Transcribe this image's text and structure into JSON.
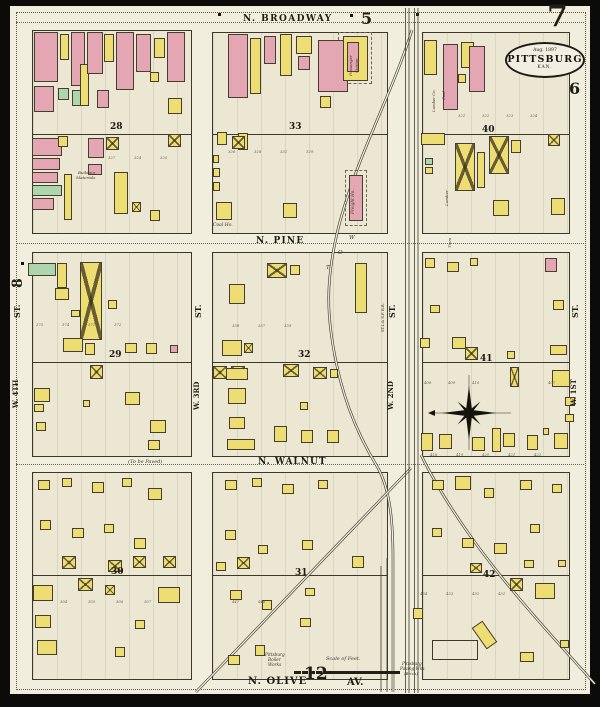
{
  "colors": {
    "paper": "#f1eedd",
    "block_fill": "#ece7d2",
    "frame_yellow": "#eedd72",
    "brick_pink": "#e4a6b2",
    "special_green": "#aed6ae",
    "ink": "#211e16",
    "rail": "#3f3b2e"
  },
  "seal": {
    "date": "Aug. 1897",
    "city": "PITTSBURG",
    "state": "KAN."
  },
  "sheet_numbers": {
    "top_right": "7",
    "top": "5",
    "right": "6",
    "left": "8",
    "bottom": "12"
  },
  "labels": [
    {
      "t": "N. BROADWAY",
      "x": 243,
      "y": 15,
      "s": 9,
      "b": 1,
      "ls": 1.4
    },
    {
      "t": "N. PINE",
      "x": 256,
      "y": 237,
      "s": 9,
      "b": 1,
      "ls": 1.2
    },
    {
      "t": "N. WALNUT",
      "x": 258,
      "y": 458,
      "s": 9,
      "b": 1,
      "ls": 1
    },
    {
      "t": "N. OLIVE",
      "x": 248,
      "y": 677,
      "s": 10,
      "b": 1,
      "ls": 1
    },
    {
      "t": "AV.",
      "x": 347,
      "y": 678,
      "s": 10,
      "b": 1
    },
    {
      "t": "5",
      "x": 361,
      "y": 11,
      "s": 16,
      "b": 1
    },
    {
      "t": "7",
      "x": 547,
      "y": 2,
      "s": 30,
      "b": 1
    },
    {
      "t": "6",
      "x": 569,
      "y": 81,
      "s": 16,
      "b": 1
    },
    {
      "t": "12",
      "x": 304,
      "y": 666,
      "s": 17,
      "b": 1
    },
    {
      "t": "8",
      "x": 11,
      "y": 288,
      "s": 14,
      "b": 1,
      "r": -90
    },
    {
      "t": "(To be Paved)",
      "x": 128,
      "y": 460,
      "s": 5,
      "i": 1
    },
    {
      "t": "Scale of Feet.",
      "x": 326,
      "y": 657,
      "s": 5,
      "i": 1
    },
    {
      "t": "Coal Ho.",
      "x": 213,
      "y": 224,
      "s": 4.5,
      "i": 1
    },
    {
      "t": "Building",
      "x": 78,
      "y": 171,
      "s": 4,
      "i": 1
    },
    {
      "t": "Materials",
      "x": 76,
      "y": 176,
      "s": 4,
      "i": 1
    },
    {
      "t": "Pittsburg",
      "x": 265,
      "y": 653,
      "s": 4.2,
      "i": 1
    },
    {
      "t": "Boiler",
      "x": 268,
      "y": 658,
      "s": 4.2,
      "i": 1
    },
    {
      "t": "Works",
      "x": 268,
      "y": 663,
      "s": 4.2,
      "i": 1
    },
    {
      "t": "Pittsburg",
      "x": 402,
      "y": 662,
      "s": 4.2,
      "i": 1
    },
    {
      "t": "Paving Wks",
      "x": 400,
      "y": 667,
      "s": 4.2,
      "i": 1
    },
    {
      "t": "(Brick)",
      "x": 404,
      "y": 672,
      "s": 4,
      "i": 1
    },
    {
      "t": "W",
      "x": 349,
      "y": 236,
      "s": 5.5,
      "i": 1
    },
    {
      "t": "O",
      "x": 338,
      "y": 251,
      "s": 5.5,
      "i": 1
    },
    {
      "t": "T",
      "x": 326,
      "y": 266,
      "s": 5.5,
      "i": 1
    },
    {
      "t": "ST.",
      "x": 13,
      "y": 318,
      "s": 8,
      "b": 1,
      "r": -90
    },
    {
      "t": "W. 4TH",
      "x": 12,
      "y": 408,
      "s": 7,
      "b": 1,
      "r": -90
    },
    {
      "t": "ST.",
      "x": 194,
      "y": 318,
      "s": 8,
      "b": 1,
      "r": -90
    },
    {
      "t": "W. 3RD",
      "x": 193,
      "y": 410,
      "s": 7,
      "b": 1,
      "r": -90
    },
    {
      "t": "ST.",
      "x": 388,
      "y": 318,
      "s": 8,
      "b": 1,
      "r": -90
    },
    {
      "t": "W. 2ND",
      "x": 387,
      "y": 410,
      "s": 7,
      "b": 1,
      "r": -90
    },
    {
      "t": "ST.",
      "x": 571,
      "y": 318,
      "s": 8,
      "b": 1,
      "r": -90
    },
    {
      "t": "W. 1ST",
      "x": 570,
      "y": 406,
      "s": 7,
      "b": 1,
      "r": -90
    },
    {
      "t": "Freight Ho.",
      "x": 351,
      "y": 214,
      "s": 4.2,
      "i": 1,
      "r": -90
    },
    {
      "t": "Passenger",
      "x": 349,
      "y": 76,
      "s": 4,
      "i": 1,
      "r": -90
    },
    {
      "t": "Station",
      "x": 355,
      "y": 73,
      "s": 4,
      "i": 1,
      "r": -90
    },
    {
      "t": "Lumber Co.",
      "x": 432,
      "y": 112,
      "s": 3.8,
      "i": 1,
      "r": -90
    },
    {
      "t": "Coal",
      "x": 442,
      "y": 100,
      "s": 3.8,
      "i": 1,
      "r": -90
    },
    {
      "t": "Lumber",
      "x": 445,
      "y": 206,
      "s": 4,
      "i": 1,
      "r": -90
    },
    {
      "t": "Tiers",
      "x": 448,
      "y": 248,
      "s": 4,
      "i": 1,
      "r": -90
    },
    {
      "t": "ST.L.& S.F. R.R.",
      "x": 382,
      "y": 332,
      "s": 3.6,
      "r": -90
    }
  ],
  "block_numbers": [
    [
      "28",
      110,
      123
    ],
    [
      "33",
      289,
      123
    ],
    [
      "40",
      482,
      126
    ],
    [
      "29",
      109,
      351
    ],
    [
      "32",
      298,
      351
    ],
    [
      "41",
      480,
      355
    ],
    [
      "30",
      111,
      568
    ],
    [
      "31",
      295,
      569
    ],
    [
      "42",
      483,
      571
    ]
  ],
  "lot_numbers": [
    [
      "327",
      108,
      156
    ],
    [
      "324",
      134,
      156
    ],
    [
      "325",
      160,
      156
    ],
    [
      "326",
      228,
      150
    ],
    [
      "328",
      254,
      150
    ],
    [
      "331",
      280,
      150
    ],
    [
      "329",
      306,
      150
    ],
    [
      "321",
      458,
      114
    ],
    [
      "322",
      482,
      114
    ],
    [
      "323",
      506,
      114
    ],
    [
      "324",
      530,
      114
    ],
    [
      "375",
      36,
      323
    ],
    [
      "374",
      62,
      323
    ],
    [
      "371",
      88,
      323
    ],
    [
      "372",
      114,
      323
    ],
    [
      "358",
      232,
      324
    ],
    [
      "357",
      258,
      324
    ],
    [
      "359",
      284,
      324
    ],
    [
      "408",
      424,
      381
    ],
    [
      "409",
      448,
      381
    ],
    [
      "410",
      472,
      381
    ],
    [
      "407",
      548,
      381
    ],
    [
      "418",
      430,
      453
    ],
    [
      "419",
      456,
      453
    ],
    [
      "420",
      482,
      453
    ],
    [
      "421",
      508,
      453
    ],
    [
      "422",
      534,
      453
    ],
    [
      "304",
      60,
      600
    ],
    [
      "305",
      88,
      600
    ],
    [
      "306",
      116,
      600
    ],
    [
      "307",
      144,
      600
    ],
    [
      "447",
      232,
      600
    ],
    [
      "448",
      258,
      600
    ],
    [
      "434",
      420,
      592
    ],
    [
      "433",
      446,
      592
    ],
    [
      "432",
      472,
      592
    ],
    [
      "431",
      498,
      592
    ]
  ],
  "blocks": [
    [
      32,
      30,
      158,
      202,
      133
    ],
    [
      212,
      32,
      174,
      200,
      133
    ],
    [
      422,
      32,
      146,
      200,
      133
    ],
    [
      32,
      252,
      158,
      203,
      361
    ],
    [
      212,
      252,
      174,
      203,
      361
    ],
    [
      422,
      252,
      146,
      203,
      361
    ],
    [
      32,
      472,
      158,
      206,
      574
    ],
    [
      212,
      472,
      174,
      206,
      574
    ],
    [
      422,
      472,
      146,
      206,
      574
    ]
  ],
  "buildings": [
    [
      34,
      32,
      24,
      50,
      "P"
    ],
    [
      34,
      86,
      20,
      26,
      "P"
    ],
    [
      60,
      34,
      9,
      26,
      "Y"
    ],
    [
      58,
      88,
      11,
      12,
      "G"
    ],
    [
      71,
      32,
      14,
      54,
      "P"
    ],
    [
      72,
      90,
      11,
      16,
      "G"
    ],
    [
      80,
      64,
      9,
      42,
      "Y"
    ],
    [
      87,
      32,
      16,
      42,
      "P"
    ],
    [
      104,
      34,
      10,
      28,
      "Y"
    ],
    [
      116,
      32,
      18,
      58,
      "P"
    ],
    [
      136,
      34,
      15,
      38,
      "P"
    ],
    [
      154,
      38,
      11,
      20,
      "Y"
    ],
    [
      150,
      72,
      9,
      10,
      "Y"
    ],
    [
      167,
      32,
      18,
      50,
      "P"
    ],
    [
      168,
      98,
      14,
      16,
      "Y"
    ],
    [
      97,
      90,
      12,
      18,
      "P"
    ],
    [
      32,
      138,
      30,
      18,
      "P"
    ],
    [
      32,
      158,
      28,
      12,
      "P"
    ],
    [
      32,
      172,
      26,
      11,
      "P"
    ],
    [
      32,
      185,
      30,
      11,
      "G"
    ],
    [
      32,
      198,
      22,
      12,
      "P"
    ],
    [
      58,
      136,
      10,
      11,
      "Y"
    ],
    [
      64,
      174,
      8,
      46,
      "Y"
    ],
    [
      88,
      138,
      16,
      20,
      "P"
    ],
    [
      106,
      137,
      13,
      13,
      "Yx"
    ],
    [
      88,
      164,
      14,
      11,
      "P"
    ],
    [
      114,
      172,
      14,
      42,
      "Y"
    ],
    [
      132,
      202,
      9,
      10,
      "Yx"
    ],
    [
      168,
      134,
      13,
      13,
      "Yx"
    ],
    [
      150,
      210,
      10,
      11,
      "Y"
    ],
    [
      338,
      32,
      34,
      52,
      "D"
    ],
    [
      228,
      34,
      20,
      64,
      "P"
    ],
    [
      250,
      38,
      11,
      56,
      "Y"
    ],
    [
      264,
      36,
      12,
      28,
      "P"
    ],
    [
      280,
      34,
      12,
      42,
      "Y"
    ],
    [
      296,
      36,
      16,
      18,
      "Y"
    ],
    [
      298,
      56,
      12,
      14,
      "P"
    ],
    [
      318,
      40,
      30,
      52,
      "P"
    ],
    [
      320,
      96,
      11,
      12,
      "Y"
    ],
    [
      343,
      36,
      25,
      45,
      "Y"
    ],
    [
      347,
      42,
      12,
      30,
      "P"
    ],
    [
      217,
      132,
      10,
      13,
      "Y"
    ],
    [
      238,
      133,
      10,
      17,
      "Y"
    ],
    [
      232,
      136,
      13,
      13,
      "Yx"
    ],
    [
      213,
      155,
      6,
      8,
      "Y"
    ],
    [
      213,
      168,
      7,
      9,
      "Y"
    ],
    [
      213,
      182,
      7,
      9,
      "Y"
    ],
    [
      216,
      202,
      16,
      18,
      "Y"
    ],
    [
      283,
      203,
      14,
      15,
      "Y"
    ],
    [
      345,
      170,
      22,
      56,
      "D"
    ],
    [
      349,
      175,
      14,
      46,
      "P"
    ],
    [
      424,
      40,
      13,
      35,
      "Y"
    ],
    [
      443,
      44,
      15,
      66,
      "P"
    ],
    [
      461,
      42,
      13,
      26,
      "Y"
    ],
    [
      469,
      46,
      16,
      46,
      "P"
    ],
    [
      458,
      74,
      8,
      9,
      "Y"
    ],
    [
      421,
      133,
      24,
      12,
      "Y"
    ],
    [
      425,
      158,
      8,
      7,
      "G"
    ],
    [
      425,
      167,
      8,
      7,
      "Y"
    ],
    [
      455,
      143,
      20,
      48,
      "Yx"
    ],
    [
      477,
      152,
      8,
      36,
      "Y"
    ],
    [
      489,
      136,
      20,
      38,
      "Yx"
    ],
    [
      511,
      140,
      10,
      13,
      "Y"
    ],
    [
      548,
      134,
      12,
      12,
      "Yx"
    ],
    [
      493,
      200,
      16,
      16,
      "Y"
    ],
    [
      551,
      198,
      14,
      17,
      "Y"
    ],
    [
      28,
      263,
      28,
      13,
      "G"
    ],
    [
      57,
      263,
      10,
      25,
      "Y"
    ],
    [
      55,
      288,
      14,
      12,
      "Y"
    ],
    [
      80,
      262,
      22,
      78,
      "Yx"
    ],
    [
      71,
      310,
      9,
      7,
      "Y"
    ],
    [
      108,
      300,
      9,
      9,
      "Y"
    ],
    [
      63,
      338,
      20,
      14,
      "Y"
    ],
    [
      85,
      343,
      10,
      12,
      "Y"
    ],
    [
      125,
      343,
      12,
      10,
      "Y"
    ],
    [
      146,
      343,
      11,
      11,
      "Y"
    ],
    [
      170,
      345,
      8,
      8,
      "P"
    ],
    [
      90,
      365,
      13,
      14,
      "Yx"
    ],
    [
      34,
      388,
      16,
      14,
      "Y"
    ],
    [
      34,
      404,
      10,
      8,
      "Y"
    ],
    [
      36,
      422,
      10,
      9,
      "Y"
    ],
    [
      125,
      392,
      15,
      13,
      "Y"
    ],
    [
      83,
      400,
      7,
      7,
      "Y"
    ],
    [
      150,
      420,
      16,
      13,
      "Y"
    ],
    [
      148,
      440,
      12,
      10,
      "Y"
    ],
    [
      267,
      263,
      20,
      15,
      "Yx"
    ],
    [
      290,
      265,
      10,
      10,
      "Y"
    ],
    [
      355,
      263,
      12,
      50,
      "Y"
    ],
    [
      229,
      284,
      16,
      20,
      "Y"
    ],
    [
      222,
      340,
      20,
      16,
      "Y"
    ],
    [
      244,
      343,
      9,
      10,
      "Yx"
    ],
    [
      213,
      366,
      14,
      13,
      "Yx"
    ],
    [
      231,
      366,
      14,
      13,
      "Yx"
    ],
    [
      283,
      364,
      16,
      13,
      "Yx"
    ],
    [
      313,
      367,
      14,
      12,
      "Yx"
    ],
    [
      330,
      369,
      8,
      9,
      "Y"
    ],
    [
      226,
      368,
      22,
      12,
      "Y"
    ],
    [
      228,
      388,
      18,
      16,
      "Y"
    ],
    [
      229,
      417,
      16,
      12,
      "Y"
    ],
    [
      227,
      439,
      28,
      11,
      "Y"
    ],
    [
      274,
      426,
      13,
      16,
      "Y"
    ],
    [
      301,
      430,
      12,
      13,
      "Y"
    ],
    [
      327,
      430,
      12,
      13,
      "Y"
    ],
    [
      300,
      402,
      8,
      8,
      "Y"
    ],
    [
      425,
      258,
      10,
      10,
      "Y"
    ],
    [
      447,
      262,
      12,
      10,
      "Y"
    ],
    [
      470,
      258,
      8,
      8,
      "Y"
    ],
    [
      545,
      258,
      12,
      14,
      "P"
    ],
    [
      430,
      305,
      10,
      8,
      "Y"
    ],
    [
      553,
      300,
      11,
      10,
      "Y"
    ],
    [
      420,
      338,
      10,
      10,
      "Y"
    ],
    [
      452,
      337,
      14,
      12,
      "Y"
    ],
    [
      465,
      347,
      13,
      13,
      "Yx"
    ],
    [
      507,
      351,
      8,
      8,
      "Y"
    ],
    [
      550,
      345,
      17,
      10,
      "Y"
    ],
    [
      510,
      367,
      9,
      20,
      "Yx"
    ],
    [
      552,
      370,
      18,
      17,
      "Y"
    ],
    [
      421,
      433,
      12,
      18,
      "Y"
    ],
    [
      439,
      434,
      13,
      15,
      "Y"
    ],
    [
      472,
      437,
      13,
      14,
      "Y"
    ],
    [
      492,
      428,
      9,
      24,
      "Y"
    ],
    [
      503,
      433,
      12,
      14,
      "Y"
    ],
    [
      527,
      435,
      11,
      15,
      "Y"
    ],
    [
      554,
      433,
      14,
      16,
      "Y"
    ],
    [
      565,
      397,
      10,
      9,
      "Y"
    ],
    [
      565,
      414,
      9,
      8,
      "Y"
    ],
    [
      543,
      428,
      6,
      7,
      "Y"
    ],
    [
      38,
      480,
      12,
      10,
      "Y"
    ],
    [
      62,
      478,
      10,
      9,
      "Y"
    ],
    [
      92,
      482,
      12,
      11,
      "Y"
    ],
    [
      122,
      478,
      10,
      9,
      "Y"
    ],
    [
      148,
      488,
      14,
      12,
      "Y"
    ],
    [
      40,
      520,
      11,
      10,
      "Y"
    ],
    [
      72,
      528,
      12,
      10,
      "Y"
    ],
    [
      104,
      524,
      10,
      9,
      "Y"
    ],
    [
      134,
      538,
      12,
      11,
      "Y"
    ],
    [
      62,
      556,
      14,
      13,
      "Yx"
    ],
    [
      108,
      560,
      14,
      12,
      "Yx"
    ],
    [
      133,
      556,
      13,
      12,
      "Yx"
    ],
    [
      163,
      556,
      13,
      12,
      "Yx"
    ],
    [
      78,
      578,
      15,
      13,
      "Yx"
    ],
    [
      105,
      585,
      10,
      10,
      "Yx"
    ],
    [
      33,
      585,
      20,
      16,
      "Y"
    ],
    [
      35,
      615,
      16,
      13,
      "Y"
    ],
    [
      37,
      640,
      20,
      15,
      "Y"
    ],
    [
      115,
      647,
      10,
      10,
      "Y"
    ],
    [
      158,
      587,
      22,
      16,
      "Y"
    ],
    [
      135,
      620,
      10,
      9,
      "Y"
    ],
    [
      225,
      480,
      12,
      10,
      "Y"
    ],
    [
      252,
      478,
      10,
      9,
      "Y"
    ],
    [
      282,
      484,
      12,
      10,
      "Y"
    ],
    [
      318,
      480,
      10,
      9,
      "Y"
    ],
    [
      225,
      530,
      11,
      10,
      "Y"
    ],
    [
      258,
      545,
      10,
      9,
      "Y"
    ],
    [
      302,
      540,
      11,
      10,
      "Y"
    ],
    [
      237,
      557,
      13,
      12,
      "Yx"
    ],
    [
      216,
      562,
      10,
      9,
      "Y"
    ],
    [
      352,
      556,
      12,
      12,
      "Y"
    ],
    [
      230,
      590,
      12,
      10,
      "Y"
    ],
    [
      262,
      600,
      10,
      10,
      "Y"
    ],
    [
      300,
      618,
      11,
      9,
      "Y"
    ],
    [
      255,
      645,
      10,
      11,
      "Y"
    ],
    [
      228,
      655,
      12,
      10,
      "Y"
    ],
    [
      305,
      588,
      10,
      8,
      "Y"
    ],
    [
      432,
      480,
      12,
      10,
      "Y"
    ],
    [
      455,
      476,
      16,
      14,
      "Y"
    ],
    [
      484,
      488,
      10,
      10,
      "Y"
    ],
    [
      520,
      480,
      12,
      10,
      "Y"
    ],
    [
      552,
      484,
      10,
      9,
      "Y"
    ],
    [
      432,
      528,
      10,
      9,
      "Y"
    ],
    [
      462,
      538,
      12,
      10,
      "Y"
    ],
    [
      494,
      543,
      13,
      11,
      "Y"
    ],
    [
      530,
      524,
      10,
      9,
      "Y"
    ],
    [
      524,
      560,
      10,
      8,
      "Y"
    ],
    [
      470,
      563,
      12,
      10,
      "Yx"
    ],
    [
      558,
      560,
      8,
      7,
      "Y"
    ],
    [
      510,
      578,
      13,
      13,
      "Yx"
    ],
    [
      535,
      583,
      20,
      16,
      "Y"
    ],
    [
      413,
      608,
      10,
      11,
      "Y"
    ],
    [
      478,
      622,
      13,
      26,
      "Y",
      -35
    ],
    [
      432,
      640,
      46,
      20,
      "O"
    ],
    [
      520,
      652,
      14,
      10,
      "Y"
    ],
    [
      560,
      640,
      9,
      8,
      "Y"
    ]
  ],
  "railroad": {
    "color": "#3f3b2e",
    "mains": [
      405.5,
      409,
      414.5,
      418
    ],
    "sidings": [
      [
        381,
        566,
        692
      ],
      [
        387,
        558,
        692
      ]
    ],
    "curves": [
      "M 412,30 C 392,95 352,165 336,238 C 328,275 327,302 331,332 C 339,392 356,432 378,468 C 391,492 393,525 393,560 L 393,692",
      "M 411,468 L 196,692",
      "M 421,455 C 466,545 536,618 595,684"
    ]
  },
  "dotlines": [
    [
      16,
      22,
      568
    ],
    [
      16,
      243,
      568
    ],
    [
      16,
      464,
      568
    ]
  ],
  "dashed_border": [
    16,
    12,
    568,
    676
  ],
  "dots": [
    [
      218,
      13
    ],
    [
      350,
      14
    ],
    [
      416,
      13
    ],
    [
      21,
      262
    ],
    [
      186,
      227
    ]
  ]
}
